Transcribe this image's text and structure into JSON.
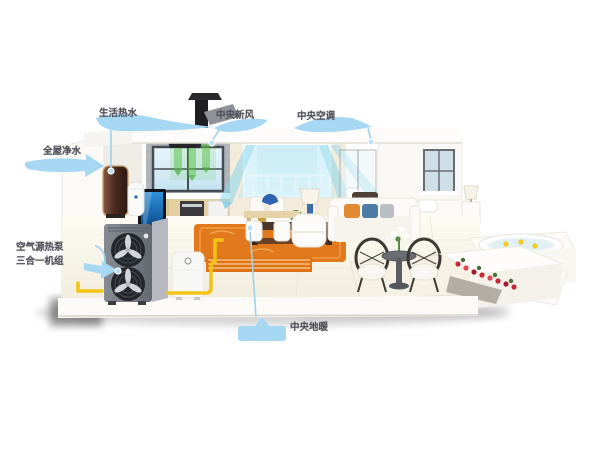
{
  "figure": {
    "type": "annotated-3d-home-heat-pump-diagram",
    "background": "#ffffff"
  },
  "callouts": {
    "hot_water": {
      "label": "生活热水"
    },
    "fresh_air": {
      "label": "中央新风"
    },
    "central_ac": {
      "label": "中央空调"
    },
    "water_purification": {
      "label": "全屋净水"
    },
    "heat_pump": {
      "label_line1": "空气源热泵",
      "label_line2": "三合一机组"
    },
    "floor_heating": {
      "label": "中央地暖"
    }
  },
  "colors": {
    "callout_blue": "#a6d8f3",
    "callout_line": "#9fd2ef",
    "callout_text": "#50505a",
    "pipe_yellow": "#f1c414",
    "rug_orange": "#e2791c",
    "floor_heating_orange": "#e07314",
    "airflow_cyan": "#8fd6ec",
    "airflow_green": "#58c046",
    "heat_pump_gray": "#787e85",
    "tank_brown": "#5d372b",
    "flower_red": "#c62838",
    "tv_screen_blue": "#1a7ac8",
    "bed_accent_blue": "#a3c3da"
  }
}
